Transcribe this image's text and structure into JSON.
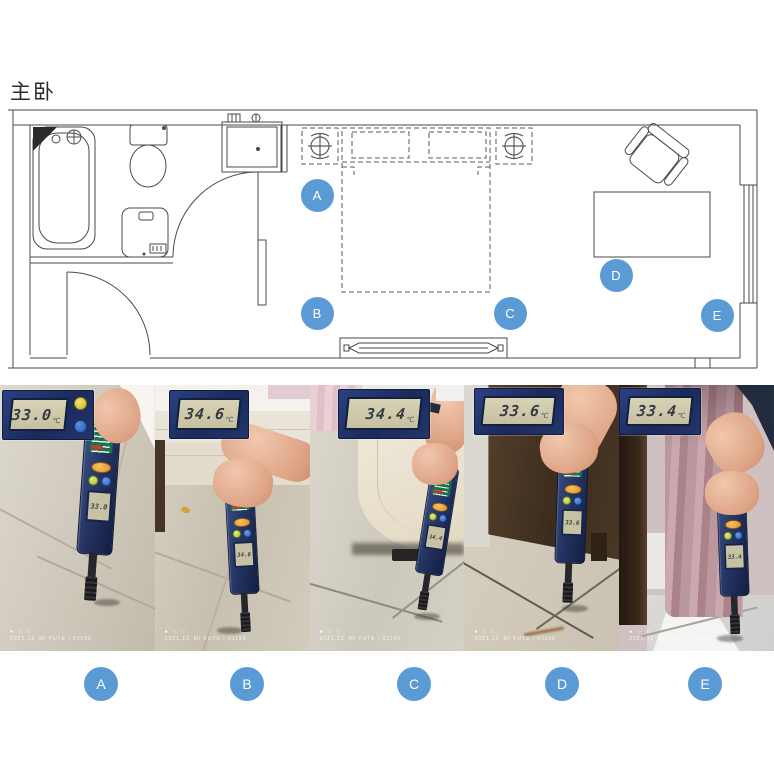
{
  "page": {
    "title": "主卧"
  },
  "floor_plan": {
    "marker_color": "#5b9bd5",
    "markers": [
      {
        "label": "A",
        "x": 317,
        "y": 195
      },
      {
        "label": "B",
        "x": 317,
        "y": 313
      },
      {
        "label": "C",
        "x": 510,
        "y": 313
      },
      {
        "label": "D",
        "x": 616,
        "y": 275
      },
      {
        "label": "E",
        "x": 717,
        "y": 315
      }
    ]
  },
  "photos": [
    {
      "label": "A",
      "reading": "33.0",
      "unit": "℃",
      "watermark_dots": "● ○ ○",
      "date": "2021.12",
      "watermark_text": "MI FUTE | 01190"
    },
    {
      "label": "B",
      "reading": "34.6",
      "unit": "℃",
      "watermark_dots": "● ○ ○",
      "date": "2021.12",
      "watermark_text": "MI FUTE | 01190"
    },
    {
      "label": "C",
      "reading": "34.4",
      "unit": "℃",
      "watermark_dots": "● ○ ○",
      "date": "2021.12",
      "watermark_text": "MI FUTE | 01190"
    },
    {
      "label": "D",
      "reading": "33.6",
      "unit": "℃",
      "watermark_dots": "● ○ ○",
      "date": "2021.12",
      "watermark_text": "MI FUTE | 01190"
    },
    {
      "label": "E",
      "reading": "33.4",
      "unit": "℃",
      "watermark_dots": "● ○ ○",
      "date": "2021.12",
      "watermark_text": "MI FUTE | 01190"
    }
  ]
}
